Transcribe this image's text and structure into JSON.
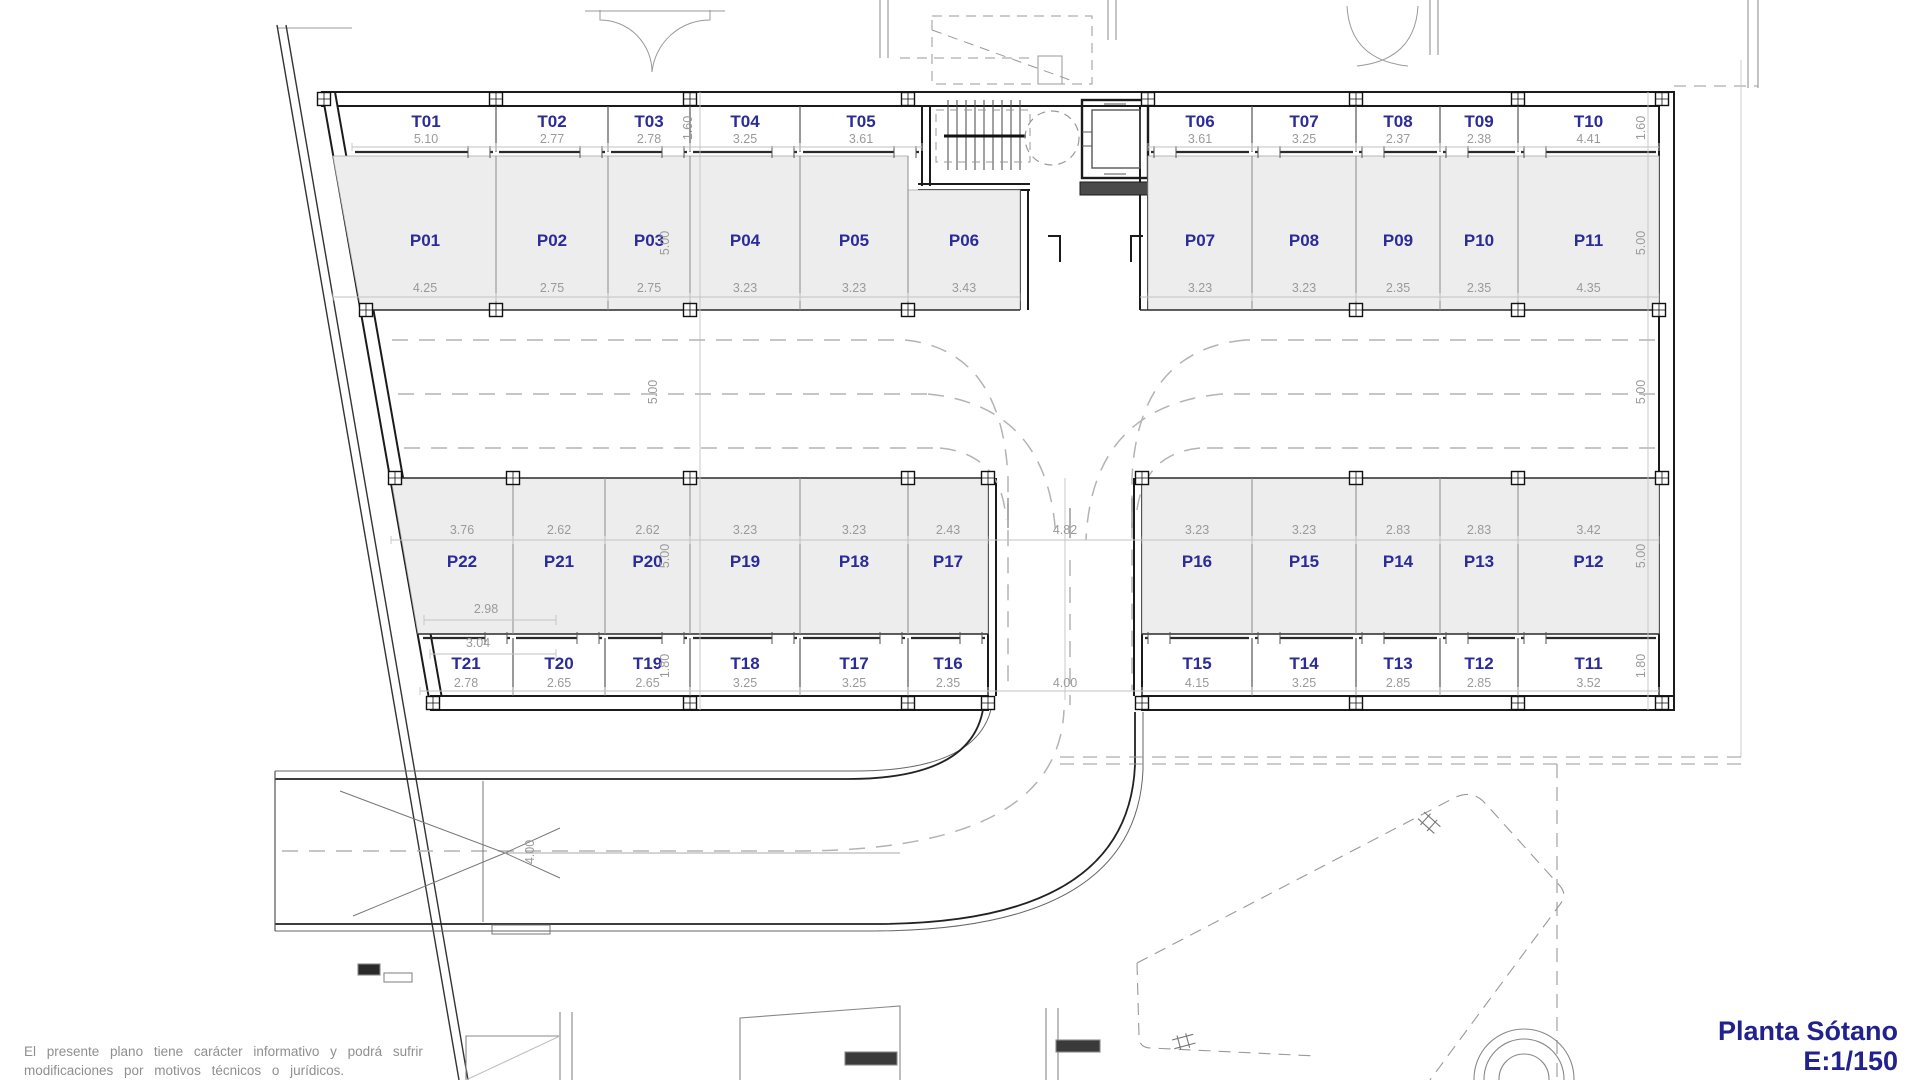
{
  "title": {
    "line1": "Planta Sótano",
    "line2": "E:1/150"
  },
  "disclaimer": {
    "line1": "El presente plano tiene carácter informativo y podrá sufrir",
    "line2": "modificaciones por motivos técnicos o jurídicos."
  },
  "colors": {
    "room_label": "#2b2b9a",
    "dimension": "#9a9a9a",
    "parking_fill": "#ededed",
    "wall": "#1b1b1b",
    "title_blue": "#22228e"
  },
  "rows": {
    "top_storage": {
      "depth": "1.60",
      "cells": [
        {
          "id": "T01",
          "width": "5.10"
        },
        {
          "id": "T02",
          "width": "2.77"
        },
        {
          "id": "T03",
          "width": "2.78"
        },
        {
          "id": "T04",
          "width": "3.25"
        },
        {
          "id": "T05",
          "width": "3.61"
        },
        {
          "id": "T06",
          "width": "3.61"
        },
        {
          "id": "T07",
          "width": "3.25"
        },
        {
          "id": "T08",
          "width": "2.37"
        },
        {
          "id": "T09",
          "width": "2.38"
        },
        {
          "id": "T10",
          "width": "4.41"
        }
      ]
    },
    "top_parking": {
      "depth": "5.00",
      "cells": [
        {
          "id": "P01",
          "width": "4.25"
        },
        {
          "id": "P02",
          "width": "2.75"
        },
        {
          "id": "P03",
          "width": "2.75"
        },
        {
          "id": "P04",
          "width": "3.23"
        },
        {
          "id": "P05",
          "width": "3.23"
        },
        {
          "id": "P06",
          "width": "3.43"
        },
        {
          "id": "P07",
          "width": "3.23"
        },
        {
          "id": "P08",
          "width": "3.23"
        },
        {
          "id": "P09",
          "width": "2.35"
        },
        {
          "id": "P10",
          "width": "2.35"
        },
        {
          "id": "P11",
          "width": "4.35"
        }
      ]
    },
    "bottom_parking": {
      "depth": "5.00",
      "ramp_opening": "4.82",
      "cells": [
        {
          "id": "P22",
          "width": "3.76"
        },
        {
          "id": "P21",
          "width": "2.62"
        },
        {
          "id": "P20",
          "width": "2.62"
        },
        {
          "id": "P19",
          "width": "3.23"
        },
        {
          "id": "P18",
          "width": "3.23"
        },
        {
          "id": "P17",
          "width": "2.43"
        },
        {
          "id": "P16",
          "width": "3.23"
        },
        {
          "id": "P15",
          "width": "3.23"
        },
        {
          "id": "P14",
          "width": "2.83"
        },
        {
          "id": "P13",
          "width": "2.83"
        },
        {
          "id": "P12",
          "width": "3.42"
        }
      ]
    },
    "bottom_storage": {
      "depth": "1.80",
      "gap": "4.00",
      "cells": [
        {
          "id": "T21",
          "width": "2.78"
        },
        {
          "id": "T20",
          "width": "2.65"
        },
        {
          "id": "T19",
          "width": "2.65"
        },
        {
          "id": "T18",
          "width": "3.25"
        },
        {
          "id": "T17",
          "width": "3.25"
        },
        {
          "id": "T16",
          "width": "2.35"
        },
        {
          "id": "T15",
          "width": "4.15"
        },
        {
          "id": "T14",
          "width": "3.25"
        },
        {
          "id": "T13",
          "width": "2.85"
        },
        {
          "id": "T12",
          "width": "2.85"
        },
        {
          "id": "T11",
          "width": "3.52"
        }
      ]
    }
  },
  "aisle": {
    "width": "5.00"
  },
  "extra_dims": {
    "left_a": "2.98",
    "left_b": "3.04",
    "road_width": "4.00"
  }
}
